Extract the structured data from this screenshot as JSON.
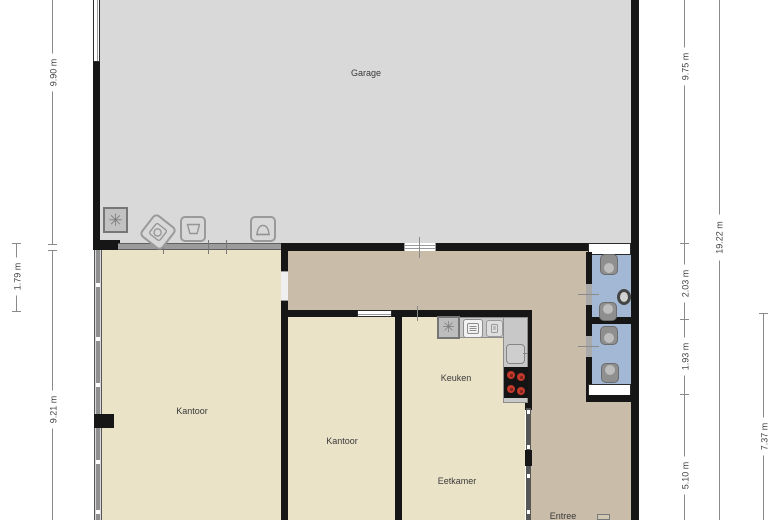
{
  "rooms": {
    "garage": {
      "label": "Garage"
    },
    "kantoor_left": {
      "label": "Kantoor"
    },
    "kantoor_middle": {
      "label": "Kantoor"
    },
    "keuken": {
      "label": "Keuken"
    },
    "eetkamer": {
      "label": "Eetkamer"
    },
    "entree": {
      "label": "Entree"
    }
  },
  "dimensions": {
    "left_garage": "9.90 m",
    "left_hall_gap": "1.79 m",
    "left_lower": "9.21 m",
    "right_garage": "9.75 m",
    "right_total": "19.22 m",
    "right_bath_top": "2.03 m",
    "right_bath_bottom": "1.93 m",
    "right_lower": "5.10 m",
    "right_inner_lower": "7.37 m"
  },
  "icons": {
    "garage_extractor": "extractor-fan-icon",
    "garage_washer": "washing-machine-icon",
    "garage_tub": "laundry-tub-icon",
    "garage_hood": "hood-icon",
    "kitchen_extractor": "extractor-fan-icon",
    "kitchen_oven": "oven-icon",
    "kitchen_appliance": "appliance-icon",
    "kitchen_sink": "sink-icon",
    "kitchen_hob": "cooktop-icon",
    "bathroom_toilet": "toilet-icon",
    "bathroom_basin": "washbasin-icon",
    "entree_door": "door-icon"
  },
  "colors": {
    "floor_garage": "#d9d9d9",
    "floor_office": "#eae3c8",
    "floor_hall": "#c9bda9",
    "floor_bath": "#a3b8d4",
    "wall": "#161616",
    "counter": "#c8c8c8",
    "hob": "#141414",
    "burner": "#c0392b"
  }
}
